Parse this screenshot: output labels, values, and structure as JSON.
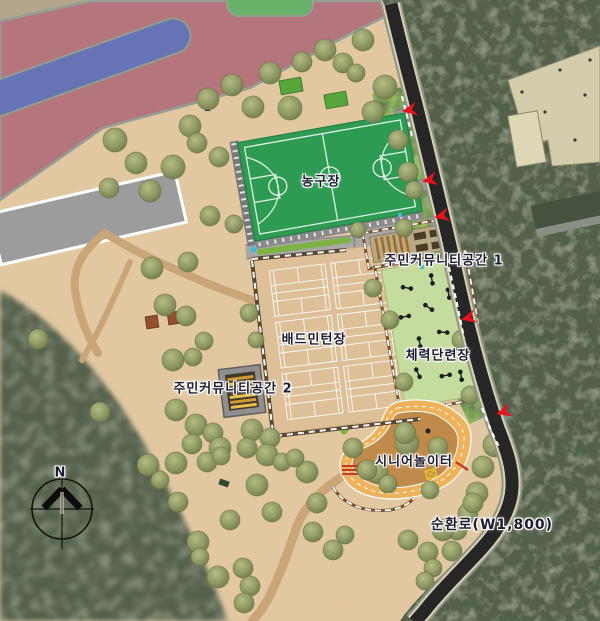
{
  "map": {
    "labels": {
      "basketball_court": "농구장",
      "badminton_court": "배드민턴장",
      "community_space_1": "주민커뮤니티공간 1",
      "community_space_2": "주민커뮤니티공간 2",
      "fitness_area": "체력단련장",
      "senior_playground": "시니어놀이터",
      "ring_road": "순환로(W1,800)",
      "compass_north": "N"
    },
    "colors": {
      "ground": "#e3c8a0",
      "plaza_pink": "#b4767c",
      "blue_lane": "#6673b5",
      "strip_green": "#68b269",
      "basketball": "#2d9b52",
      "badminton": "#ddc098",
      "fitness": "#c5dc9f",
      "lawn": "#93bf5b",
      "track": "#eeb25a",
      "track_inner": "#c08a4a",
      "road": "#262626",
      "forest": "#57604c",
      "building": "#9c9c9c",
      "marker": "#e8121c"
    }
  }
}
